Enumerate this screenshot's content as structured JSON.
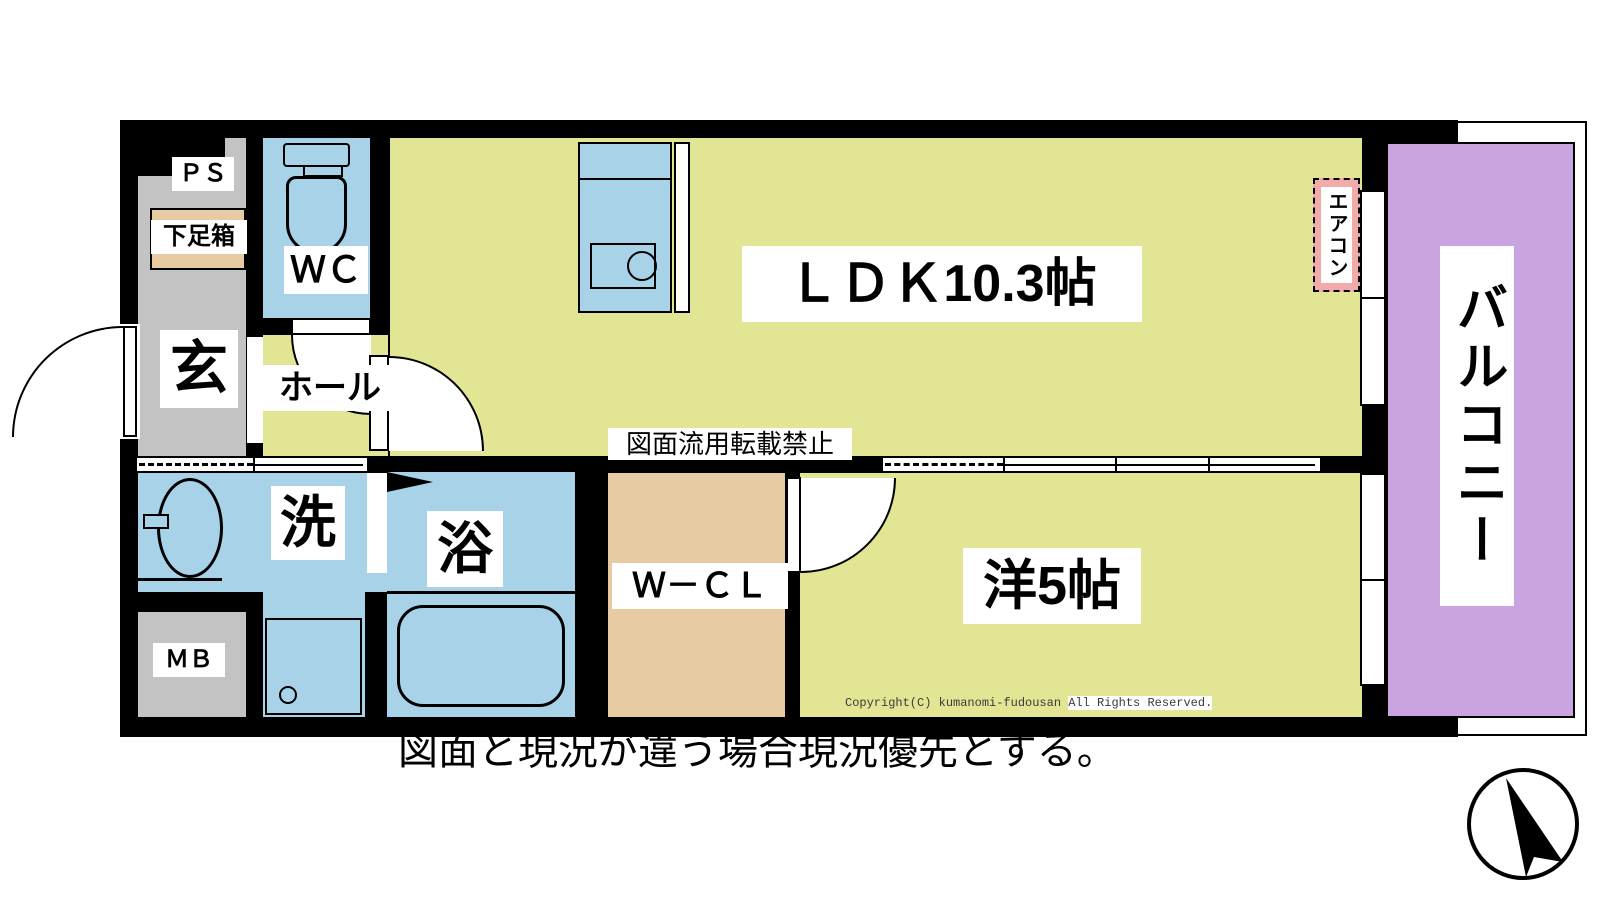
{
  "plan": {
    "rooms": {
      "ps": "ＰＳ",
      "shoe_box": "下足箱",
      "wc": "ＷＣ",
      "entrance": "玄",
      "hall": "ホール",
      "ldk": "ＬＤＫ10.3帖",
      "aircon": "エアコン",
      "balcony": "バルコニー",
      "washroom": "洗",
      "bath": "浴",
      "meter_box": "ＭＢ",
      "walk_in_closet": "Ｗ－ＣＬ",
      "western_room": "洋5帖"
    },
    "watermark": "図面流用転載禁止"
  },
  "footer": {
    "copyright_left": "Copyright(C) kumanomi-fudousan ",
    "copyright_right": "All Rights Reserved.",
    "notice": "図面と現況が違う場合現況優先とする。"
  },
  "colors": {
    "floor": "#e2e593",
    "water": "#a7d2e8",
    "balcony": "#c9a4e0",
    "gray": "#c3c3c3",
    "wood": "#e6cba3",
    "aircon-pink": "#f2abab",
    "wall": "#000000"
  }
}
